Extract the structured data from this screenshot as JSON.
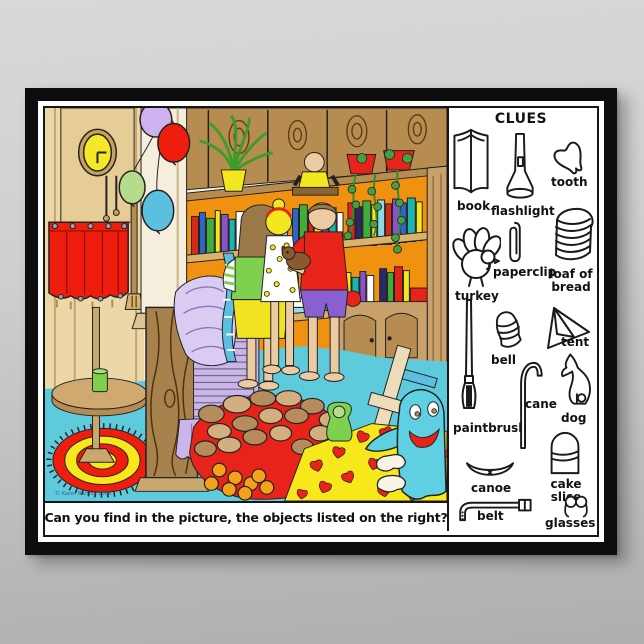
{
  "poster": {
    "caption": "Can you find in the picture, the objects listed on the right?",
    "copyright": "© Karen Barthol 2004",
    "clues": {
      "title": "CLUES",
      "items": [
        {
          "id": "book",
          "label": "book"
        },
        {
          "id": "flashlight",
          "label": "flashlight"
        },
        {
          "id": "tooth",
          "label": "tooth"
        },
        {
          "id": "paperclip",
          "label": "paperclip"
        },
        {
          "id": "loaf-of-bread",
          "label": "loaf of bread"
        },
        {
          "id": "turkey",
          "label": "turkey"
        },
        {
          "id": "bell",
          "label": "bell"
        },
        {
          "id": "tent",
          "label": "tent"
        },
        {
          "id": "paintbrush",
          "label": "paintbrush"
        },
        {
          "id": "cane",
          "label": "cane"
        },
        {
          "id": "dog",
          "label": "dog"
        },
        {
          "id": "cake-slice",
          "label": "cake slice"
        },
        {
          "id": "canoe",
          "label": "canoe"
        },
        {
          "id": "belt",
          "label": "belt"
        },
        {
          "id": "glasses",
          "label": "glasses"
        }
      ]
    },
    "colors": {
      "frame": "#0d0d0d",
      "backdrop_top": "#d9d9d9",
      "backdrop_bottom": "#aeaeb0",
      "floor_cyan": "#5ecbdc",
      "shelf_orange": "#f0920f",
      "accent_red": "#e8231a",
      "accent_yellow": "#f6e81a",
      "chair_lavender": "#c9b5e8",
      "ghost_cyan": "#5fd0e2",
      "wood_brown": "#a8824c"
    }
  }
}
